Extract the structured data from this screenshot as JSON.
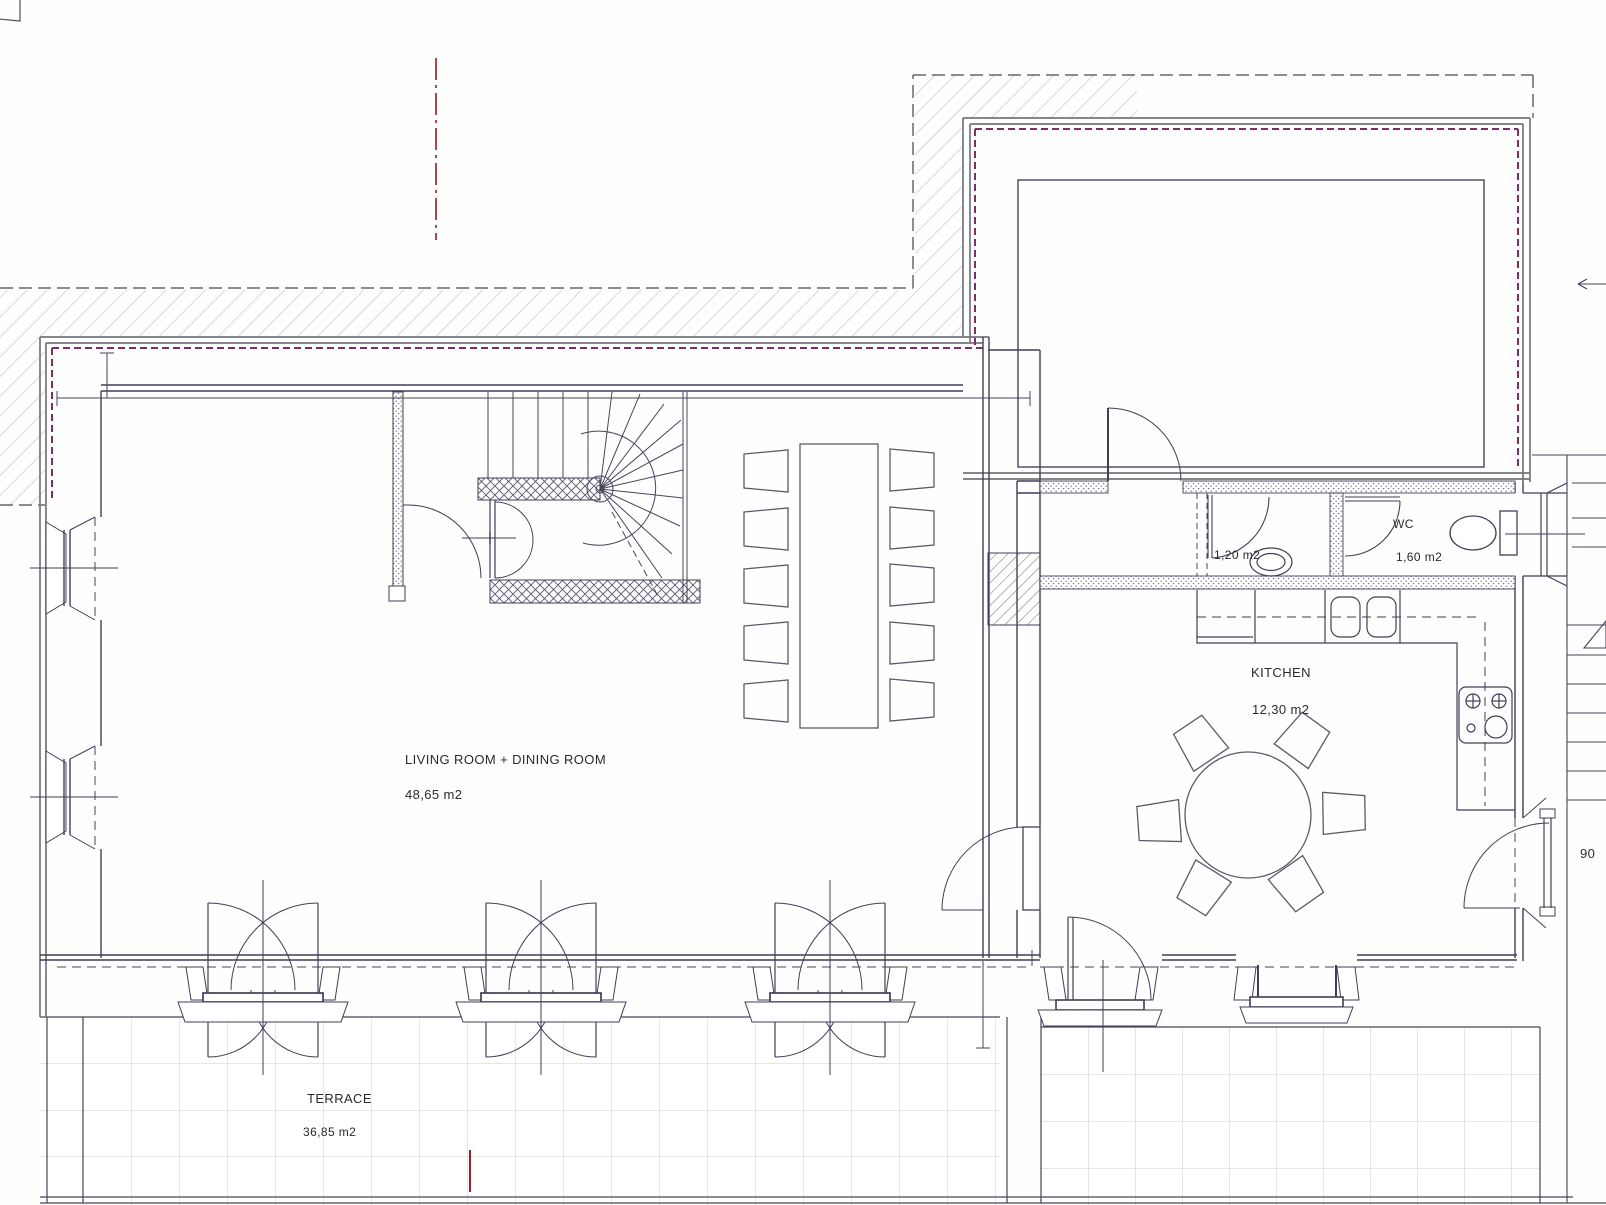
{
  "plan": {
    "rooms": {
      "living_dining": {
        "name": "LIVING ROOM + DINING ROOM",
        "area": "48,65 m2"
      },
      "kitchen": {
        "name": "KITCHEN",
        "area": "12,30 m2"
      },
      "wc": {
        "name": "WC",
        "area": "1,60 m2"
      },
      "washroom": {
        "area": "1,20 m2"
      },
      "terrace": {
        "name": "TERRACE",
        "area": "36,85 m2"
      }
    },
    "annotations": {
      "door_width": "90"
    },
    "colors": {
      "wall": "#3f3f58",
      "outer_wall": "#74747c",
      "insulation_line": "#7c2e66",
      "centerline_red": "#a13535",
      "hatch": "#c4c4cc",
      "tile_grid": "#cdcdd2",
      "text": "#2a2a2a"
    }
  }
}
